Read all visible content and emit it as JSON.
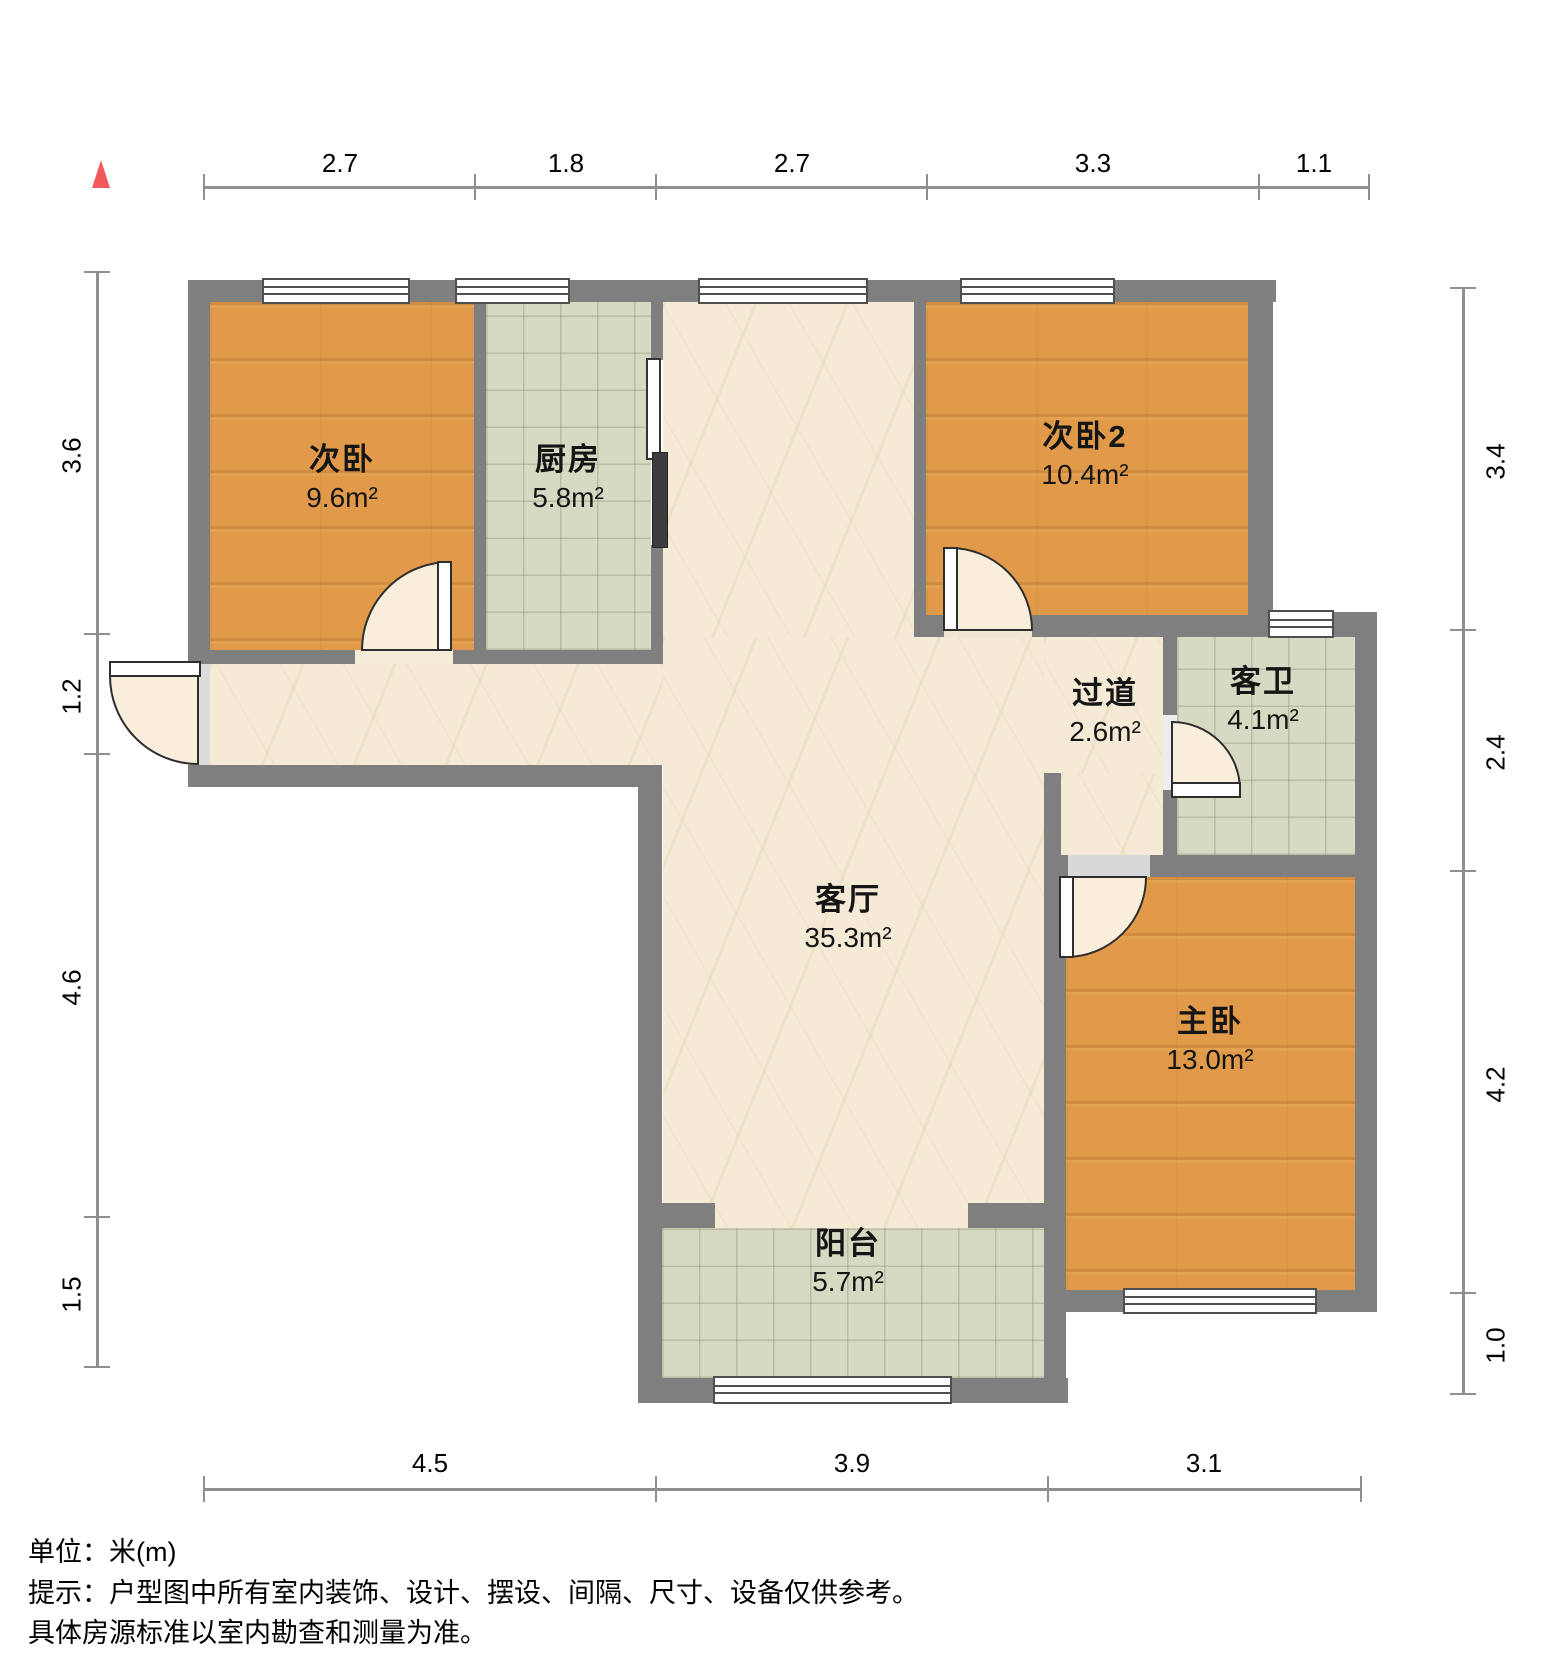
{
  "rooms": [
    {
      "id": "bedroom2",
      "name": "次卧",
      "area": "9.6m²",
      "floor": "wood"
    },
    {
      "id": "kitchen",
      "name": "厨房",
      "area": "5.8m²",
      "floor": "tile"
    },
    {
      "id": "bedroom3",
      "name": "次卧2",
      "area": "10.4m²",
      "floor": "wood"
    },
    {
      "id": "hallway",
      "name": "过道",
      "area": "2.6m²",
      "floor": "marble"
    },
    {
      "id": "bathroom",
      "name": "客卫",
      "area": "4.1m²",
      "floor": "tile"
    },
    {
      "id": "living",
      "name": "客厅",
      "area": "35.3m²",
      "floor": "marble"
    },
    {
      "id": "master",
      "name": "主卧",
      "area": "13.0m²",
      "floor": "wood"
    },
    {
      "id": "balcony",
      "name": "阳台",
      "area": "5.7m²",
      "floor": "tile"
    }
  ],
  "dimensions": {
    "top": [
      "2.7",
      "1.8",
      "2.7",
      "3.3",
      "1.1"
    ],
    "left": [
      "3.6",
      "1.2",
      "4.6",
      "1.5"
    ],
    "right": [
      "3.4",
      "2.4",
      "4.2",
      "1.0"
    ],
    "bottom": [
      "4.5",
      "3.9",
      "3.1"
    ]
  },
  "footer": {
    "line1": "单位：米(m)",
    "line2": "提示：户型图中所有室内装饰、设计、摆设、间隔、尺寸、设备仅供参考。",
    "line3": "具体房源标准以室内勘查和测量为准。"
  },
  "colors": {
    "wall": "#7f7f7f",
    "accent": "#f2585c",
    "wood_floor": "#e09a4a",
    "tile_floor": "#d7d9c3",
    "marble_floor": "#f4ead5"
  },
  "icons": {
    "compass": "north-triangle-icon"
  }
}
